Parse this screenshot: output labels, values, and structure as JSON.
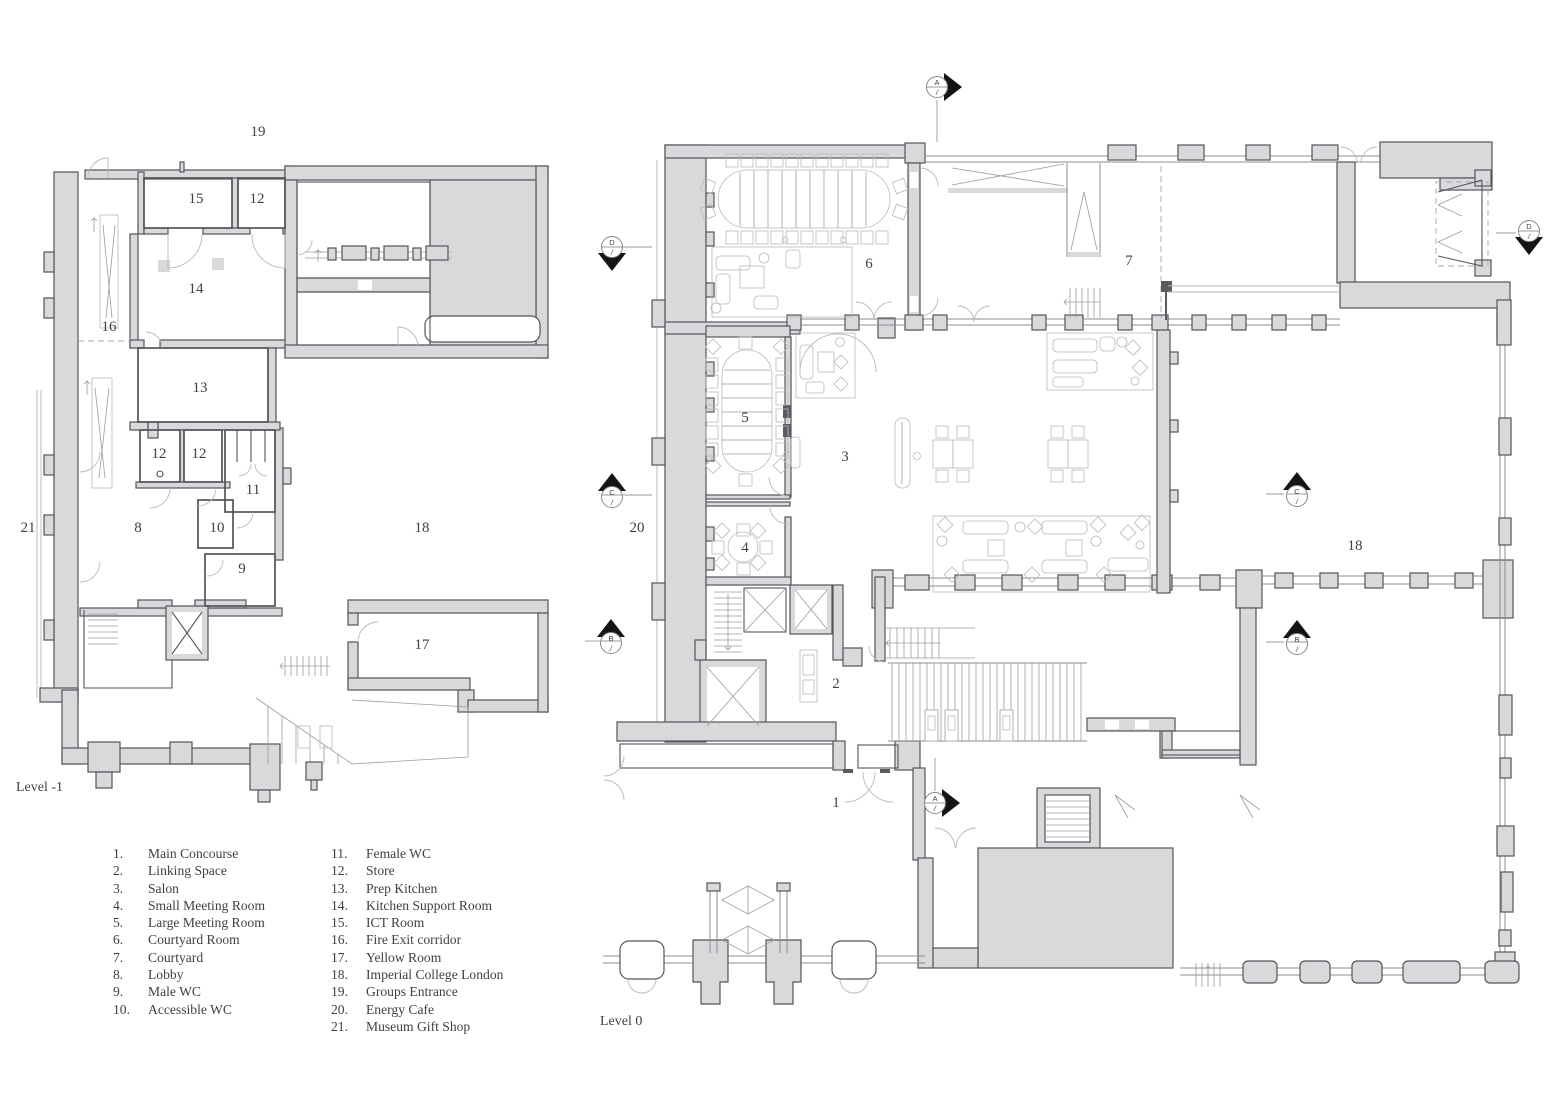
{
  "title": "Floor plans — Level -1 and Level 0",
  "colors": {
    "background": "#ffffff",
    "wall_fill": "#d9d9db",
    "wall_outline": "#54545a",
    "thin_line": "#b6b6ba",
    "text": "#3f3f44",
    "marker_black": "#141414"
  },
  "legend": {
    "items": [
      {
        "num": "1.",
        "name": "Main Concourse"
      },
      {
        "num": "2.",
        "name": "Linking Space"
      },
      {
        "num": "3.",
        "name": "Salon"
      },
      {
        "num": "4.",
        "name": "Small Meeting Room"
      },
      {
        "num": "5.",
        "name": "Large Meeting Room"
      },
      {
        "num": "6.",
        "name": "Courtyard Room"
      },
      {
        "num": "7.",
        "name": "Courtyard"
      },
      {
        "num": "8.",
        "name": "Lobby"
      },
      {
        "num": "9.",
        "name": "Male WC"
      },
      {
        "num": "10.",
        "name": "Accessible WC"
      },
      {
        "num": "11.",
        "name": "Female WC"
      },
      {
        "num": "12.",
        "name": "Store"
      },
      {
        "num": "13.",
        "name": "Prep Kitchen"
      },
      {
        "num": "14.",
        "name": "Kitchen Support Room"
      },
      {
        "num": "15.",
        "name": "ICT Room"
      },
      {
        "num": "16.",
        "name": "Fire Exit corridor"
      },
      {
        "num": "17.",
        "name": "Yellow Room"
      },
      {
        "num": "18.",
        "name": "Imperial College London"
      },
      {
        "num": "19.",
        "name": "Groups Entrance"
      },
      {
        "num": "20.",
        "name": "Energy Cafe"
      },
      {
        "num": "21.",
        "name": "Museum Gift Shop"
      }
    ]
  },
  "plans": {
    "level_minus_1": {
      "label": "Level -1",
      "room_labels": [
        {
          "n": "19"
        },
        {
          "n": "15"
        },
        {
          "n": "12"
        },
        {
          "n": "14"
        },
        {
          "n": "16"
        },
        {
          "n": "13"
        },
        {
          "n": "12"
        },
        {
          "n": "12"
        },
        {
          "n": "11"
        },
        {
          "n": "21"
        },
        {
          "n": "8"
        },
        {
          "n": "10"
        },
        {
          "n": "18"
        },
        {
          "n": "9"
        },
        {
          "n": "17"
        }
      ]
    },
    "level_0": {
      "label": "Level 0",
      "room_labels": [
        {
          "n": "6"
        },
        {
          "n": "7"
        },
        {
          "n": "5"
        },
        {
          "n": "3"
        },
        {
          "n": "20"
        },
        {
          "n": "4"
        },
        {
          "n": "18"
        },
        {
          "n": "2"
        },
        {
          "n": "1"
        }
      ],
      "section_markers": [
        {
          "letter": "A",
          "sub": "/"
        },
        {
          "letter": "D",
          "sub": "/"
        },
        {
          "letter": "C",
          "sub": "/"
        },
        {
          "letter": "B",
          "sub": "/"
        },
        {
          "letter": "B",
          "sub": "/"
        },
        {
          "letter": "C",
          "sub": "/"
        },
        {
          "letter": "D",
          "sub": "/"
        },
        {
          "letter": "A",
          "sub": "/"
        }
      ]
    }
  }
}
